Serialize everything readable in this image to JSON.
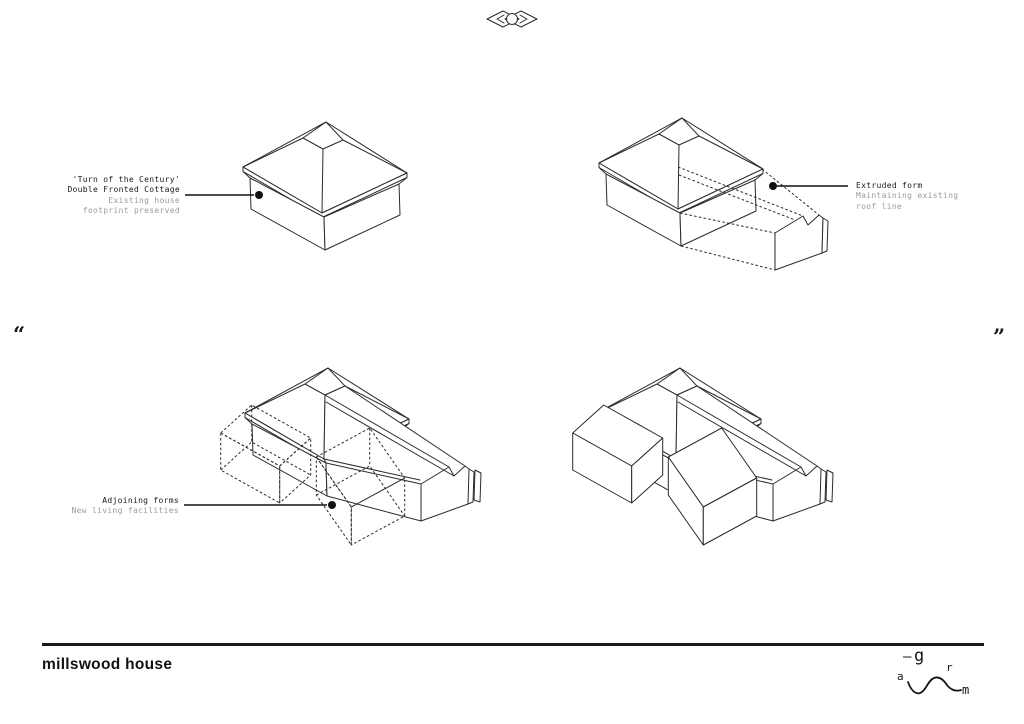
{
  "colors": {
    "ink": "#1a1a1a",
    "line": "#2b2b2b",
    "muted": "#9b9b9b",
    "paper": "#ffffff"
  },
  "quotes": {
    "open": "“",
    "close": "”"
  },
  "annotations": {
    "existing": {
      "primary": [
        "'Turn of the Century'",
        "Double Fronted Cottage"
      ],
      "secondary": [
        "Existing house",
        "footprint preserved"
      ]
    },
    "extruded": {
      "primary": [
        "Extruded form"
      ],
      "secondary": [
        "Maintaining existing",
        "roof line"
      ]
    },
    "adjoining": {
      "primary": [
        "Adjoining forms"
      ],
      "secondary": [
        "New living facilities"
      ]
    }
  },
  "footer": {
    "title": "millswood house",
    "logo": {
      "dash": "—",
      "g": "g",
      "r": "r",
      "a": "a",
      "m": "m"
    }
  }
}
